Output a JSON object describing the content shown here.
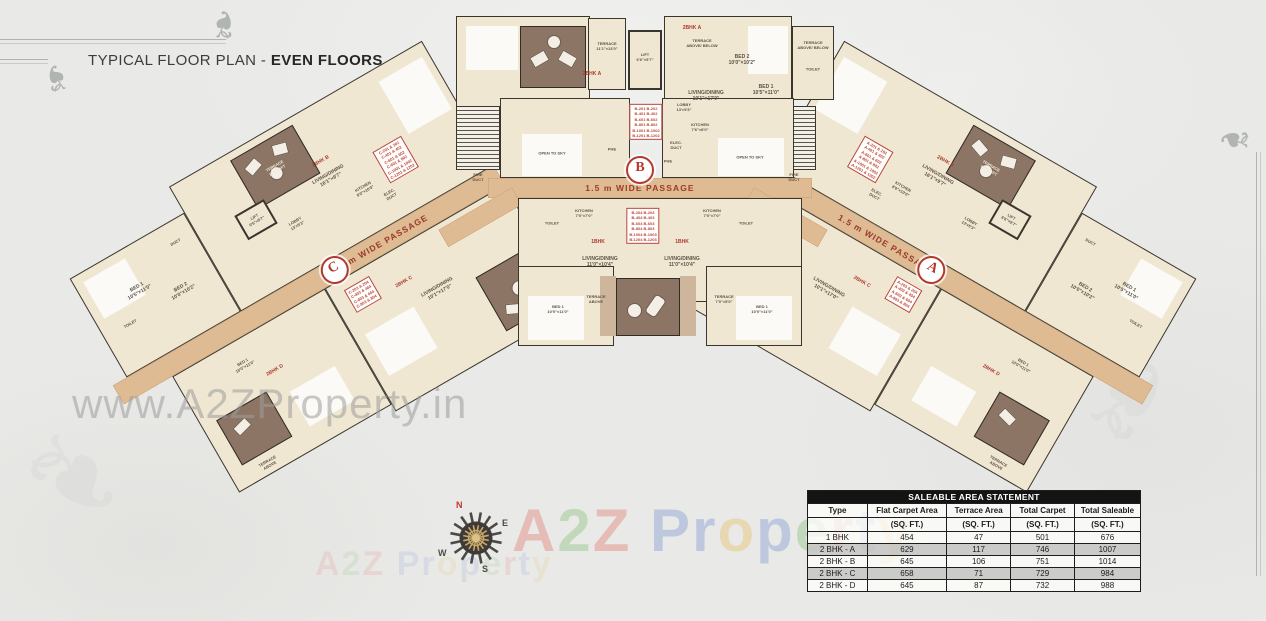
{
  "title": {
    "prefix": "TYPICAL FLOOR PLAN - ",
    "emphasis": "EVEN FLOORS"
  },
  "passage_label": "1.5 m WIDE PASSAGE",
  "wings": {
    "a": "A",
    "b": "B",
    "c": "C"
  },
  "unit_types": {
    "t1": "1BHK",
    "t2a": "2BHK A",
    "t2b": "2BHK B",
    "t2c": "2BHK C",
    "t2d": "2BHK D"
  },
  "rooms": {
    "lift": "LIFT\n6'6\"×5'7\"",
    "lobby": "LOBBY\n13'×5'3\"",
    "kitchen": "KITCHEN\n7'6\"×8'0\"",
    "kitchen2": "KITCHEN\n8'0\"×10'0\"",
    "kitchen_s": "KITCHEN\n7'0\"×7'0\"",
    "living_dining": "LIVING/DINING\n10'1\"×17'0\"",
    "living_dining2": "LIVING/DINING\n16'1\"×9'7\"",
    "ld_s": "LIVING/DINING\n11'0\"×10'4\"",
    "bed1": "BED 1\n10'5\"×11'0\"",
    "bed2": "BED 2\n10'0\"×10'2\"",
    "bed1_s": "BED 1\n10'0\"×11'0\"",
    "terrace_top": "TERRACE\n11'1\"×13'0\"",
    "terrace_ab": "TERRACE\nABOVE/ BELOW",
    "terrace_above": "TERRACE\nABOVE",
    "terrace_190": "TERRACE\n190 SQFT",
    "terrace_s": "TERRACE\n7'0\"×5'0\"",
    "open_sky": "OPEN TO SKY",
    "elec": "ELEC.\nDUCT",
    "fire": "FIRE\nDUCT",
    "phe": "PHE",
    "duct": "DUCT",
    "toilet": "TOILET"
  },
  "stacks": {
    "b_upper": "B-201  B-202\nB-401  B-402\nB-601  B-602\nB-801  B-802\nB-1001 B-1002\nB-1201 B-1202",
    "b_lower": "B-204  B-203\nB-404  B-403\nB-604  B-603\nB-804  B-803\nB-1004 B-1003\nB-1204 B-1203",
    "c_main": "C-201 & 202\nC-401 & 402\nC-601 & 602\nC-801 & 802\nC-1001 & 1002\nC-1201 & 1202",
    "c_lower": "C-203 & 204\nC-403 & 404\nC-603 & 604\nC-803 & 804",
    "a_main": "A-201 & 202\nA-401 & 402\nA-601 & 602\nA-801 & 802\nA-1001 & 1002\nA-1201 & 1202",
    "a_lower": "A-203 & 204\nA-403 & 404\nA-603 & 604\nA-803 & 804"
  },
  "compass": {
    "n": "N",
    "e": "E",
    "s": "S",
    "w": "W"
  },
  "watermark": {
    "url_text": "www.A2ZProperty.in",
    "brand_letters": [
      {
        "ch": "A",
        "color": "#e2574c"
      },
      {
        "ch": "2",
        "color": "#6cb354"
      },
      {
        "ch": "Z",
        "color": "#e2574c"
      },
      {
        "ch": " ",
        "color": "#000000"
      },
      {
        "ch": "P",
        "color": "#5b7fcd"
      },
      {
        "ch": "r",
        "color": "#5b7fcd"
      },
      {
        "ch": "o",
        "color": "#e8b33c"
      },
      {
        "ch": "p",
        "color": "#5b7fcd"
      },
      {
        "ch": "e",
        "color": "#6cb354"
      },
      {
        "ch": "r",
        "color": "#e2574c"
      },
      {
        "ch": "t",
        "color": "#5b7fcd"
      },
      {
        "ch": "y",
        "color": "#e8b33c"
      }
    ]
  },
  "table": {
    "title": "SALEABLE AREA STATEMENT",
    "columns": [
      "Type",
      "Flat Carpet Area",
      "Terrace Area",
      "Total Carpet",
      "Total Saleable"
    ],
    "unit_row": [
      "",
      "(SQ. FT.)",
      "(SQ. FT.)",
      "(SQ. FT.)",
      "(SQ. FT.)"
    ],
    "rows": [
      [
        "1 BHK",
        "454",
        "47",
        "501",
        "676"
      ],
      [
        "2 BHK - A",
        "629",
        "117",
        "746",
        "1007"
      ],
      [
        "2 BHK - B",
        "645",
        "106",
        "751",
        "1014"
      ],
      [
        "2 BHK - C",
        "658",
        "71",
        "729",
        "984"
      ],
      [
        "2 BHK - D",
        "645",
        "87",
        "732",
        "988"
      ]
    ]
  }
}
